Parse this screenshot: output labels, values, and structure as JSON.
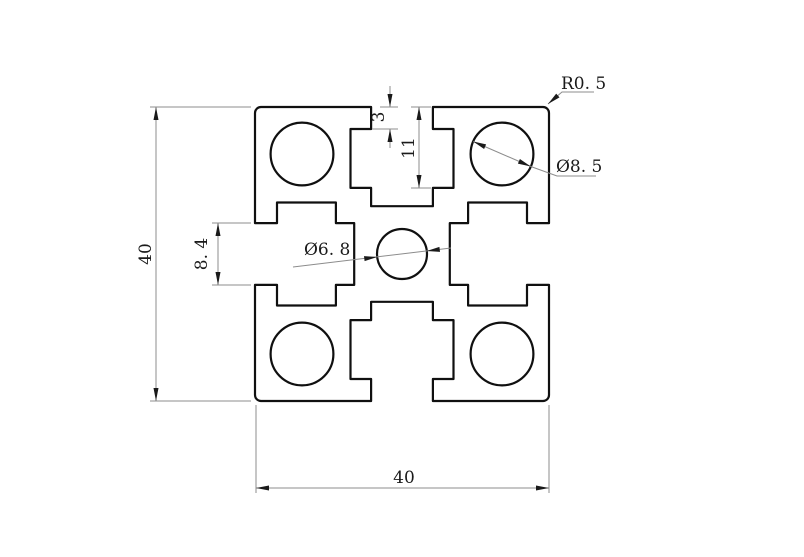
{
  "page": {
    "background": "#ffffff"
  },
  "drawing": {
    "subject": "40x40 T-slot aluminium extrusion profile cross-section",
    "profile_fill": "#e9eae3",
    "outline_color": "#101010",
    "dim_line_color": "#8c8c8c",
    "text_color": "#1a1a1a",
    "labels": {
      "overall_height": "40",
      "overall_width": "40",
      "slot_opening": "8. 4",
      "slot_lip": "3",
      "slot_depth": "11",
      "corner_radius": "R0. 5",
      "corner_hole_dia": "Ø8. 5",
      "center_hole_dia": "Ø6. 8"
    }
  }
}
